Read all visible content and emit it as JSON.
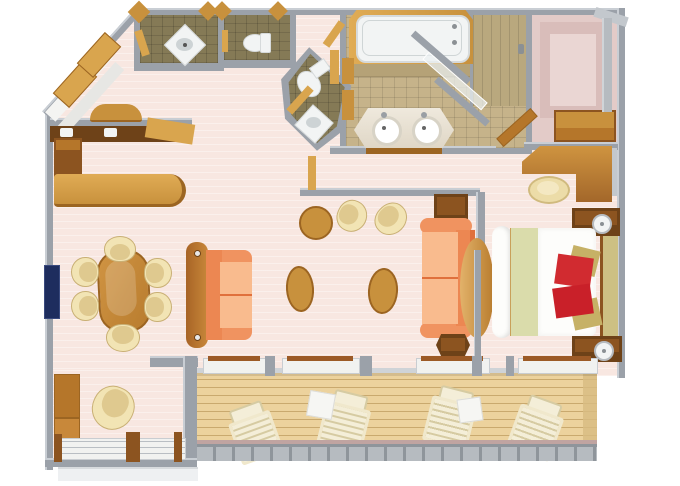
{
  "meta": {
    "title": "3D top-down floor plan of a suite with veranda",
    "render_style": "isometric-top-down 3D render, no text labels",
    "canvas": {
      "width": 680,
      "height": 486
    }
  },
  "rooms": [
    {
      "name": "entry-foyer"
    },
    {
      "name": "wet-bar"
    },
    {
      "name": "guest-shower-room"
    },
    {
      "name": "guest-toilet-room"
    },
    {
      "name": "powder-room"
    },
    {
      "name": "master-bathroom"
    },
    {
      "name": "shower-stall"
    },
    {
      "name": "walk-in-closet"
    },
    {
      "name": "living-dining-room"
    },
    {
      "name": "bedroom"
    },
    {
      "name": "sitting-alcove"
    },
    {
      "name": "veranda-deck"
    }
  ],
  "furniture": [
    "entry-bench-pair",
    "hall-console-half-round",
    "wet-bar-counter",
    "bar-counter",
    "dining-table-oval",
    "dining-chairs-x6",
    "wall-tv",
    "sofa-left",
    "sofa-right",
    "coffee-ottoman-x2",
    "bistro-table",
    "barrel-chair-pair",
    "side-table",
    "end-table",
    "round-divider-column",
    "bathtub",
    "double-sink-vanity",
    "shower-glass-door",
    "toilet-x2",
    "corner-sink-x2",
    "closet-dresser",
    "closet-rod",
    "vanity-desk",
    "desk-stool",
    "nightstand-with-lamp-x2",
    "king-bed-white-duvet-red-gold-pillows",
    "headboard",
    "alcove-cabinets",
    "alcove-barrel-chair",
    "lounge-chair-x4",
    "deck-side-table-x2",
    "deck-railing"
  ],
  "colors": {
    "wall": "#9ba1a9",
    "wall_light": "#c9ced4",
    "wall_face": "#c3c8cd",
    "floor_pink": "#f8e7e1",
    "tile_olive": "#857a56",
    "tile_sand": "#c6b38a",
    "tile_shower": "#b9a87e",
    "carpet_mauve": "#e3cbc8",
    "carpet_mauve_dark": "#d9bdba",
    "carpet_mauve_light": "#ead6d3",
    "wood": "#c8913d",
    "wood_light": "#d9a54e",
    "wood_lighter": "#e0ac55",
    "wood_mid": "#b5762a",
    "wood_dark": "#8c5420",
    "wood_deep": "#6e4218",
    "wood_edge": "#9c6522",
    "deck": "#ecd29d",
    "deck_line": "#c9a96e",
    "deck_shade": "#d8bc82",
    "sofa": "#f09360",
    "sofa_back": "#ec8752",
    "sofa_seat": "#f9bb8e",
    "sofa_shadow": "#e0703c",
    "cream": "#f2e4b4",
    "cream_dark": "#dfc98f",
    "cream_edge": "#c9b075",
    "white_fixture": "#f2f4f4",
    "fixture_edge": "#d6dadb",
    "basin": "#cdd3d5",
    "marble": "#efe9dd",
    "marble_dark": "#ded5c4",
    "bed_white": "#fdfdfb",
    "sage": "#dadcab",
    "pillow_red": "#d12b30",
    "pillow_red_dark": "#c92029",
    "pillow_gold": "#c6b166",
    "headboard": "#cdc083",
    "tv": "#1e2d5e",
    "glass": "rgba(235,241,243,0.72)",
    "railing": "#b6bbc0",
    "railing_tick": "#8f959b",
    "railing_mauve": "#c0a4a1",
    "lounge_frame": "#f0e8cc",
    "lounge_slat": "#d6cba2",
    "lounge_white": "#f4eed8",
    "table_white": "#f6f6f3"
  }
}
